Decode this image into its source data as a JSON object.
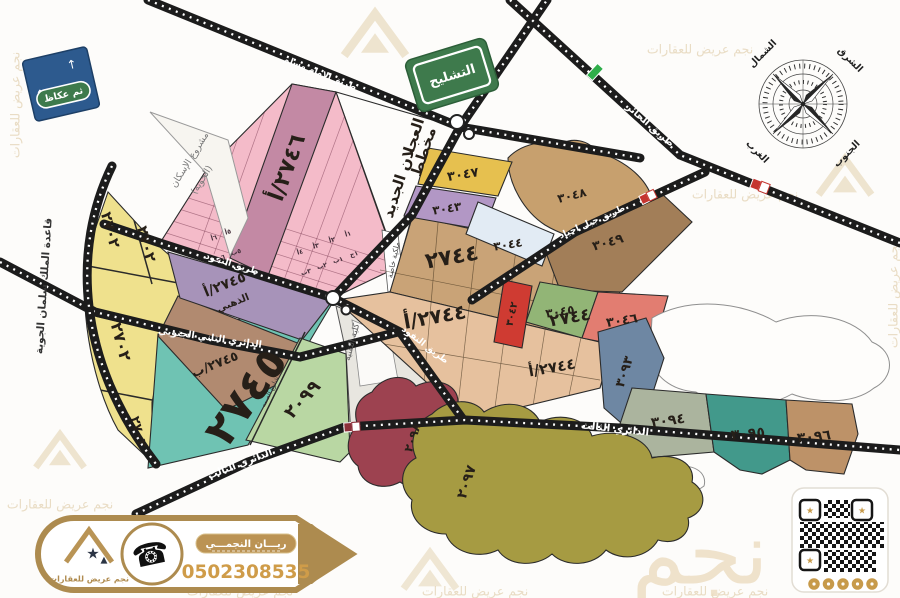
{
  "signs": {
    "tashlih": "التشليح",
    "okaz": "ثم عكاظ"
  },
  "compass": {
    "north": "الشمال",
    "east": "الشرق",
    "west": "الغرب",
    "south": "الجنوب"
  },
  "roads": {
    "imam_muslim": "طريق الامام مسلم",
    "hair": "طريق الحائر",
    "jabal_ajyad": "طريق جبل اجياد",
    "nafud": "طريق النفود",
    "second_ring_south": "الدائري الثاني الجنوبي",
    "third_ring": "الدائري الثالث",
    "samah_street": "شارع الصمه"
  },
  "landmarks": {
    "airbase": "قاعدة الملك سلمان الجوية",
    "housing_project": "مشروع الإسكان",
    "housing_project_sub": "(الحوية)",
    "ajlan_line1": "مخطط",
    "ajlan_line2": "العجلان الجديد",
    "tech_college": "كلية التقنية",
    "private_property": "ملكية خاصة"
  },
  "zones": {
    "z2702": {
      "label": "٢٧٠٢",
      "color": "#efe18d"
    },
    "z2745a": {
      "label": "٢٧٤٥/أ",
      "sub": "الذهبي",
      "color": "#a793b9"
    },
    "z2745b": {
      "label": "٢٧٤٥/ب",
      "color": "#b18a70"
    },
    "z2745": {
      "label": "٢٧٤٥",
      "color": "#6fc3b3"
    },
    "z2746a": {
      "label": "٢٧٤٦/أ",
      "color": "#c389a4"
    },
    "pink_grid": {
      "color": "#f4bbc9",
      "cells": [
        "٦أ",
        "٥أ",
        "٦ب",
        "٥ب",
        "٤أ",
        "٣أ",
        "٢أ",
        "١أ",
        "٣ب",
        "٢ب",
        "١ب",
        "١ج"
      ]
    },
    "z2744": {
      "label": "٢٧٤٤",
      "color": "#c9a377"
    },
    "z2744a": {
      "label": "٢٧٤٤/أ",
      "color": "#e6c19e"
    },
    "z3042": {
      "label": "٣٠٤٢",
      "color": "#cf3b32"
    },
    "z3043": {
      "label": "٣٠٤٣",
      "color": "#b297c5"
    },
    "z3044": {
      "label": "٣٠٤٤",
      "color": "#e2ebf4"
    },
    "z3045": {
      "label": "٣٠٤٥",
      "color": "#92b576"
    },
    "z3046": {
      "label": "٣٠٤٦",
      "color": "#e27d71"
    },
    "z3047": {
      "label": "٣٠٤٧",
      "color": "#e6c04f"
    },
    "z3048": {
      "label": "٣٠٤٨",
      "color": "#c7a06e"
    },
    "z3049": {
      "label": "٣٠٤٩",
      "color": "#a27e58"
    },
    "z2097": {
      "label": "٢٠٩٧",
      "color": "#a69b42"
    },
    "z2098": {
      "label": "٢٠٩٨",
      "color": "#9d4250"
    },
    "z2099": {
      "label": "٢٠٩٩",
      "color": "#b9d7a3"
    },
    "z3093": {
      "label": "٣٠٩٣",
      "color": "#6e87a3"
    },
    "z3094": {
      "label": "٣٠٩٤",
      "color": "#abb49e"
    },
    "z3095": {
      "label": "٣٠٩٥",
      "color": "#42998b"
    },
    "z3096": {
      "label": "٣٠٩٦",
      "color": "#bd9268"
    }
  },
  "footer": {
    "agent_name": "ريـــان النجمـــي",
    "phone": "0502308535",
    "brand": "نجم عريض للعقارات"
  },
  "watermark": {
    "text": "نجم عريض للعقارات",
    "big": "نجم"
  },
  "colors": {
    "gold": "#ad8b4f",
    "gold_light": "#c79a4a",
    "sign_green": "#3e7a4c",
    "sign_blue": "#2d5a8e",
    "road": "#1c1c1c"
  }
}
